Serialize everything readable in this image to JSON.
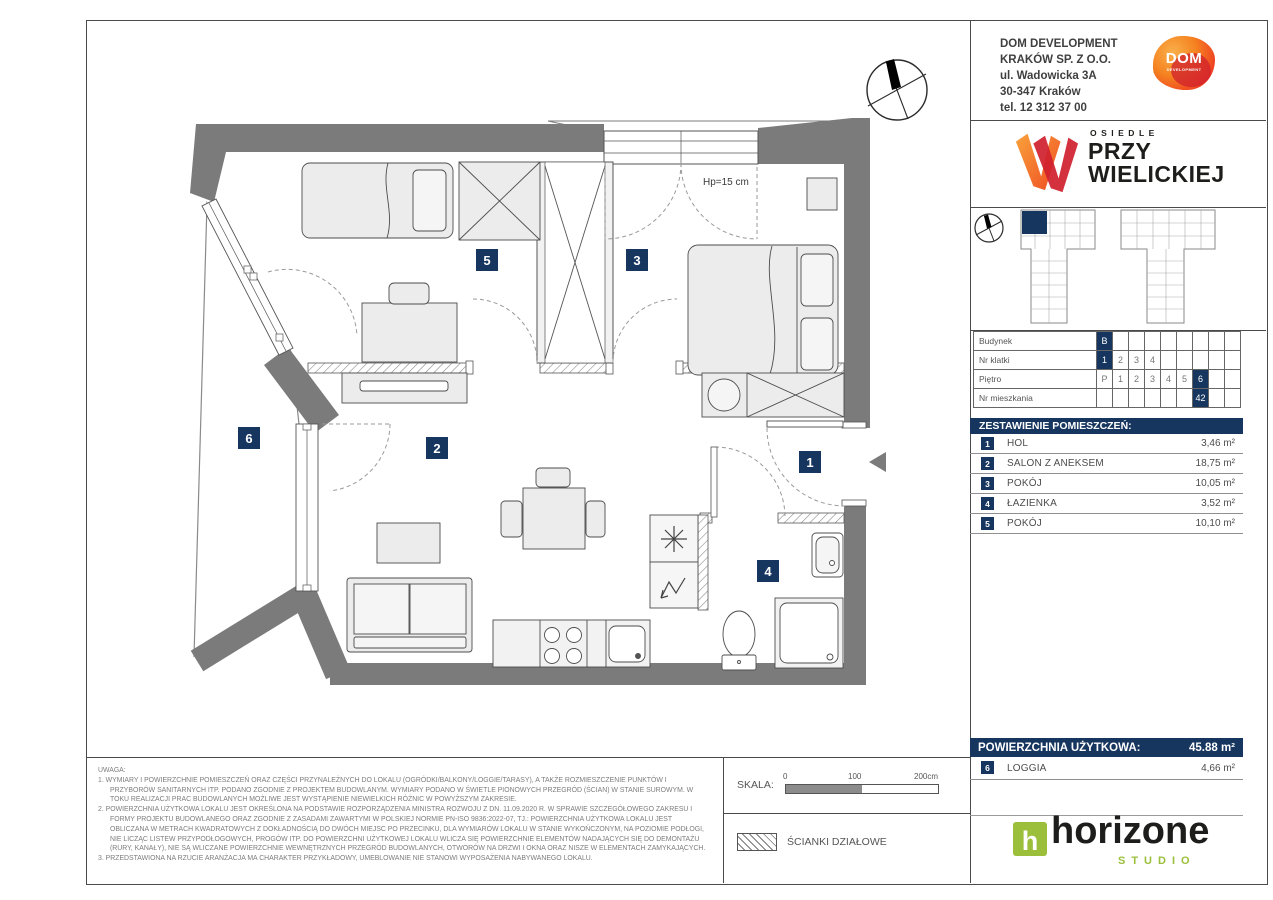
{
  "company": {
    "lines": "DOM DEVELOPMENT\nKRAKÓW SP. Z O.O.\nul. Wadowicka 3A\n30-347 Kraków\ntel. 12 312 37 00"
  },
  "dom_logo": {
    "title": "DOM",
    "subtitle": "DEVELOPMENT"
  },
  "estate": {
    "eyebrow": "OSIEDLE",
    "line1": "PRZY",
    "line2": "WIELICKIEJ"
  },
  "unit_grid": {
    "rows": [
      {
        "label": "Budynek",
        "cells": [
          "B",
          "",
          "",
          "",
          "",
          "",
          "",
          "",
          ""
        ],
        "hl": 0
      },
      {
        "label": "Nr klatki",
        "cells": [
          "1",
          "2",
          "3",
          "4",
          "",
          "",
          "",
          "",
          ""
        ],
        "hl": 0
      },
      {
        "label": "Piętro",
        "cells": [
          "P",
          "1",
          "2",
          "3",
          "4",
          "5",
          "6",
          "",
          ""
        ],
        "hl": 6
      },
      {
        "label": "Nr mieszkania",
        "cells": [
          "",
          "",
          "",
          "",
          "",
          "",
          "42",
          "",
          ""
        ],
        "hl": 6
      }
    ]
  },
  "rooms": {
    "header": "ZESTAWIENIE POMIESZCZEŃ:",
    "items": [
      {
        "no": "1",
        "name": "HOL",
        "area": "3,46 m²"
      },
      {
        "no": "2",
        "name": "SALON Z ANEKSEM",
        "area": "18,75 m²"
      },
      {
        "no": "3",
        "name": "POKÓJ",
        "area": "10,05 m²"
      },
      {
        "no": "4",
        "name": "ŁAZIENKA",
        "area": "3,52 m²"
      },
      {
        "no": "5",
        "name": "POKÓJ",
        "area": "10,10 m²"
      }
    ]
  },
  "summary": {
    "label": "POWIERZCHNIA UŻYTKOWA:",
    "value": "45.88 m²"
  },
  "loggia": {
    "no": "6",
    "name": "LOGGIA",
    "area": "4,66 m²"
  },
  "notes": {
    "heading": "UWAGA:",
    "items": [
      "1. WYMIARY I POWIERZCHNIE POMIESZCZEŃ ORAZ CZĘŚCI PRZYNALEŻNYCH DO LOKALU (OGRÓDKI/BALKONY/LOGGIE/TARASY), A TAKŻE ROZMIESZCZENIE PUNKTÓW I PRZYBORÓW SANITARNYCH ITP. PODANO ZGODNIE Z PROJEKTEM BUDOWLANYM. WYMIARY PODANO W ŚWIETLE PIONOWYCH PRZEGRÓD (ŚCIAN) W STANIE SUROWYM. W TOKU REALIZACJI PRAC BUDOWLANYCH MOŻLIWE JEST WYSTĄPIENIE NIEWIELKICH RÓŻNIC W POWYŻSZYM ZAKRESIE.",
      "2. POWIERZCHNIA UŻYTKOWA LOKALU JEST OKREŚLONA NA PODSTAWIE ROZPORZĄDZENIA MINISTRA ROZWOJU Z DN. 11.09.2020 R. W SPRAWIE SZCZEGÓŁOWEGO ZAKRESU I FORMY PROJEKTU BUDOWLANEGO ORAZ ZGODNIE Z ZASADAMI ZAWARTYMI W POLSKIEJ NORMIE PN-ISO 9836:2022-07, TJ.: POWIERZCHNIA UŻYTKOWA LOKALU JEST OBLICZANA W METRACH KWADRATOWYCH Z DOKŁADNOŚCIĄ DO DWÓCH MIEJSC PO PRZECINKU, DLA WYMIARÓW LOKALU W STANIE WYKOŃCZONYM, NA POZIOMIE PODŁOGI, NIE LICZĄC LISTEW PRZYPODŁOGOWYCH, PROGÓW ITP. DO POWIERZCHNI UŻYTKOWEJ LOKALU WLICZA SIĘ POWIERZCHNIE ELEMENTÓW NADAJĄCYCH SIĘ DO DEMONTAŻU (RURY, KANAŁY), NIE SĄ WLICZANE POWIERZCHNIE WEWNĘTRZNYCH PRZEGRÓD BUDOWLANYCH, OTWORÓW NA DRZWI I OKNA ORAZ NISZE W ELEMENTACH ZAMYKAJĄCYCH.",
      "3. PRZEDSTAWIONA NA RZUCIE ARANŻACJA MA CHARAKTER PRZYKŁADOWY, UMEBLOWANIE NIE STANOWI WYPOSAŻENIA NABYWANEGO LOKALU."
    ]
  },
  "scale": {
    "label": "SKALA:",
    "t0": "0",
    "t100": "100",
    "t200": "200cm"
  },
  "legend": {
    "label": "ŚCIANKI DZIAŁOWE"
  },
  "studio": {
    "h": "h",
    "name": "horizone",
    "sub": "STUDIO"
  },
  "plan": {
    "badge1": "1",
    "badge2": "2",
    "badge3": "3",
    "badge4": "4",
    "badge5": "5",
    "badge6": "6",
    "window_note": "Hp=15 cm"
  },
  "colors": {
    "navy": "#16365f",
    "wall": "#7b7b7b",
    "green": "#9bbf3b",
    "orange": "#f58220",
    "red": "#d0202e"
  }
}
